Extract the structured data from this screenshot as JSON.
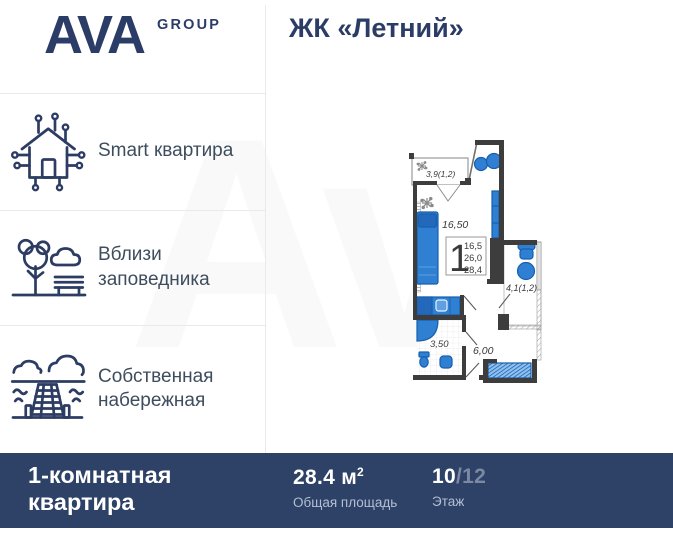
{
  "brand": {
    "name": "AVA",
    "suffix": "GROUP"
  },
  "header": {
    "title": "ЖК «Летний»"
  },
  "watermark": {
    "text": "Av"
  },
  "features": [
    {
      "icon": "smart-home-icon",
      "label": "Smart квартира"
    },
    {
      "icon": "park-icon",
      "label": "Вблизи заповедника"
    },
    {
      "icon": "embankment-icon",
      "label": "Собственная набережная"
    }
  ],
  "floor_plan": {
    "balcony_top_label": "3,9(1,2)",
    "living_room_label": "16,50",
    "rooms_count": "1",
    "areas": [
      "16,5",
      "26,0",
      "28,4"
    ],
    "balcony_right_label": "4,1(1,2)",
    "bathroom_label": "3,50",
    "hallway_label": "6,00"
  },
  "footer": {
    "apartment_type": "1-комнатная квартира",
    "area_value": "28.4 м",
    "area_sup": "2",
    "area_caption": "Общая площадь",
    "floor_value": "10",
    "floor_total": "/12",
    "floor_caption": "Этаж"
  },
  "colors": {
    "accent_navy": "#2b3c66",
    "bar_bg": "#2e4166",
    "plan_blue": "#2f7fd3",
    "wall": "#3d3d3d"
  }
}
